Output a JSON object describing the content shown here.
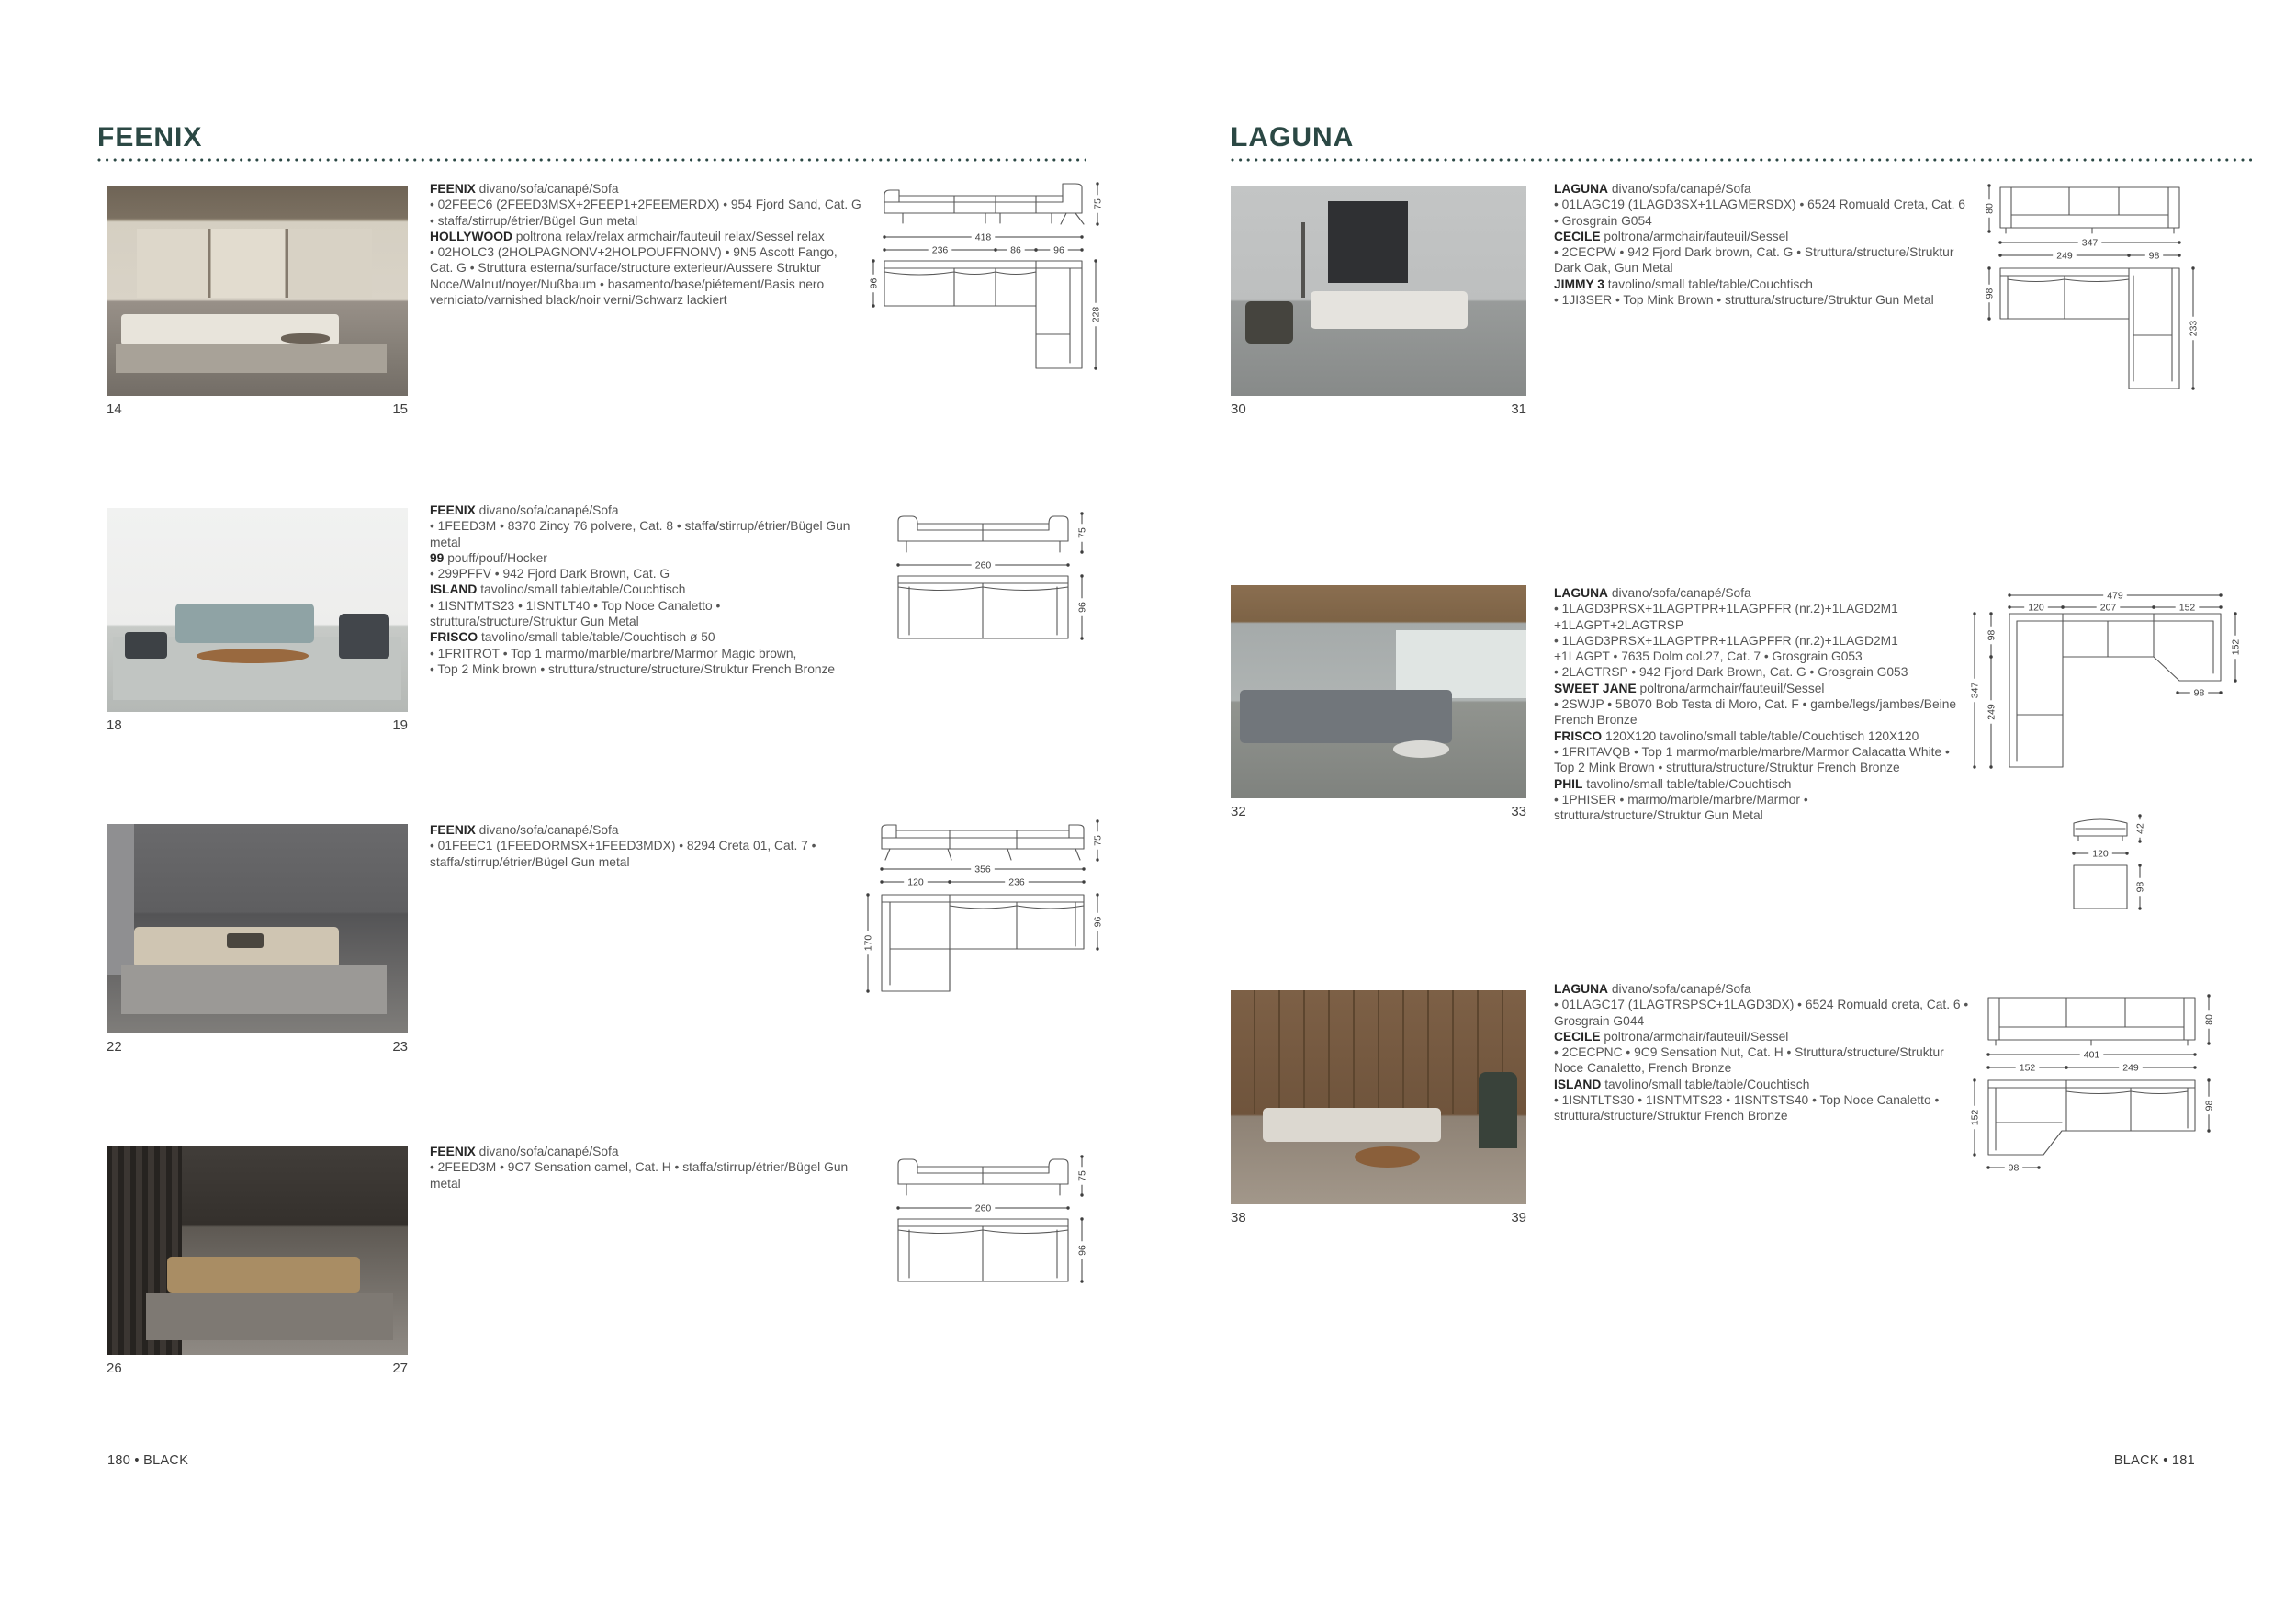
{
  "accent_color": "#2b4844",
  "pages": {
    "left": {
      "title": "FEENIX",
      "footer": "180 • BLACK",
      "blocks": [
        {
          "nums": {
            "l": "14",
            "r": "15"
          },
          "desc": [
            {
              "b": true,
              "t": "FEENIX"
            },
            {
              "t": " divano/sofa/canapé/Sofa\n"
            },
            {
              "t": "• 02FEEC6 (2FEED3MSX+2FEEP1+2FEEMERDX) • 954 Fjord Sand, Cat. G • staffa/stirrup/étrier/Bügel Gun metal\n"
            },
            {
              "b": true,
              "t": "HOLLYWOOD"
            },
            {
              "t": " poltrona relax/relax armchair/fauteuil relax/Sessel relax\n"
            },
            {
              "t": "• 02HOLC3 (2HOLPAGNONV+2HOLPOUFFNONV) • 9N5 Ascott Fango, Cat. G • Struttura esterna/surface/structure exterieur/Aussere Struktur Noce/Walnut/noyer/Nußbaum • basamento/base/piétement/Basis nero verniciato/varnished black/noir verni/Schwarz lackiert"
            }
          ]
        },
        {
          "nums": {
            "l": "18",
            "r": "19"
          },
          "desc": [
            {
              "b": true,
              "t": "FEENIX"
            },
            {
              "t": " divano/sofa/canapé/Sofa\n"
            },
            {
              "t": "• 1FEED3M • 8370 Zincy 76 polvere, Cat. 8 • staffa/stirrup/étrier/Bügel Gun metal\n"
            },
            {
              "b": true,
              "t": "99"
            },
            {
              "t": " pouff/pouf/Hocker\n"
            },
            {
              "t": "• 299PFFV • 942 Fjord Dark Brown, Cat. G\n"
            },
            {
              "b": true,
              "t": "ISLAND"
            },
            {
              "t": " tavolino/small table/table/Couchtisch\n"
            },
            {
              "t": "• 1ISNTMTS23 • 1ISNTLT40 • Top Noce Canaletto • struttura/structure/Struktur Gun Metal\n"
            },
            {
              "b": true,
              "t": "FRISCO"
            },
            {
              "t": " tavolino/small table/table/Couchtisch ø 50\n"
            },
            {
              "t": "• 1FRITROT • Top 1 marmo/marble/marbre/Marmor Magic brown,\n• Top 2 Mink brown • struttura/structure/structure/Struktur French Bronze"
            }
          ]
        },
        {
          "nums": {
            "l": "22",
            "r": "23"
          },
          "desc": [
            {
              "b": true,
              "t": "FEENIX"
            },
            {
              "t": " divano/sofa/canapé/Sofa\n"
            },
            {
              "t": "• 01FEEC1 (1FEEDORMSX+1FEED3MDX) • 8294 Creta 01, Cat. 7 • staffa/stirrup/étrier/Bügel Gun metal"
            }
          ]
        },
        {
          "nums": {
            "l": "26",
            "r": "27"
          },
          "desc": [
            {
              "b": true,
              "t": "FEENIX"
            },
            {
              "t": " divano/sofa/canapé/Sofa\n"
            },
            {
              "t": "• 2FEED3M • 9C7 Sensation camel, Cat. H • staffa/stirrup/étrier/Bügel Gun metal"
            }
          ]
        }
      ],
      "drawings": {
        "d1": {
          "height": "75",
          "total": "418",
          "seg1": "236",
          "seg2": "86",
          "seg3": "96",
          "depth": "96",
          "chaise": "228"
        },
        "d2": {
          "height": "75",
          "width": "260",
          "depth": "96"
        },
        "d3": {
          "height": "75",
          "total": "356",
          "seg1": "120",
          "seg2": "236",
          "chaise": "170",
          "depth": "96"
        },
        "d4": {
          "height": "75",
          "width": "260",
          "depth": "96"
        }
      }
    },
    "right": {
      "title": "LAGUNA",
      "footer": "BLACK • 181",
      "blocks": [
        {
          "nums": {
            "l": "30",
            "r": "31"
          },
          "desc": [
            {
              "b": true,
              "t": "LAGUNA"
            },
            {
              "t": " divano/sofa/canapé/Sofa\n"
            },
            {
              "t": "• 01LAGC19 (1LAGD3SX+1LAGMERSDX) • 6524 Romuald Creta, Cat. 6 • Grosgrain G054\n"
            },
            {
              "b": true,
              "t": "CECILE"
            },
            {
              "t": " poltrona/armchair/fauteuil/Sessel\n"
            },
            {
              "t": "• 2CECPW • 942 Fjord Dark brown, Cat. G • Struttura/structure/Struktur Dark Oak, Gun Metal\n"
            },
            {
              "b": true,
              "t": "JIMMY 3"
            },
            {
              "t": " tavolino/small table/table/Couchtisch\n"
            },
            {
              "t": "• 1JI3SER • Top Mink Brown • struttura/structure/Struktur Gun Metal"
            }
          ]
        },
        {
          "nums": {
            "l": "32",
            "r": "33"
          },
          "desc": [
            {
              "b": true,
              "t": "LAGUNA"
            },
            {
              "t": " divano/sofa/canapé/Sofa\n"
            },
            {
              "t": "• 1LAGD3PRSX+1LAGPTPR+1LAGPFFR (nr.2)+1LAGD2M1\n+1LAGPT+2LAGTRSP\n"
            },
            {
              "t": "• 1LAGD3PRSX+1LAGPTPR+1LAGPFFR (nr.2)+1LAGD2M1\n+1LAGPT • 7635 Dolm col.27, Cat. 7 • Grosgrain G053\n"
            },
            {
              "t": "• 2LAGTRSP • 942 Fjord Dark Brown, Cat. G • Grosgrain G053\n"
            },
            {
              "b": true,
              "t": "SWEET JANE"
            },
            {
              "t": " poltrona/armchair/fauteuil/Sessel\n"
            },
            {
              "t": "• 2SWJP • 5B070 Bob Testa di Moro, Cat. F • gambe/legs/jambes/Beine French Bronze\n"
            },
            {
              "b": true,
              "t": "FRISCO"
            },
            {
              "t": " 120X120 tavolino/small table/table/Couchtisch 120X120\n"
            },
            {
              "t": "• 1FRITAVQB • Top 1 marmo/marble/marbre/Marmor Calacatta White • Top 2 Mink Brown • struttura/structure/Struktur French Bronze\n"
            },
            {
              "b": true,
              "t": "PHIL"
            },
            {
              "t": " tavolino/small table/table/Couchtisch\n"
            },
            {
              "t": "• 1PHISER • marmo/marble/marbre/Marmor • struttura/structure/Struktur Gun Metal"
            }
          ]
        },
        {
          "nums": {
            "l": "38",
            "r": "39"
          },
          "desc": [
            {
              "b": true,
              "t": "LAGUNA"
            },
            {
              "t": " divano/sofa/canapé/Sofa\n"
            },
            {
              "t": "• 01LAGC17 (1LAGTRSPSC+1LAGD3DX) • 6524 Romuald creta, Cat. 6 • Grosgrain G044\n"
            },
            {
              "b": true,
              "t": "CECILE"
            },
            {
              "t": " poltrona/armchair/fauteuil/Sessel\n"
            },
            {
              "t": "• 2CECPNC • 9C9 Sensation Nut, Cat. H • Struttura/structure/Struktur Noce Canaletto, French Bronze\n"
            },
            {
              "b": true,
              "t": "ISLAND"
            },
            {
              "t": " tavolino/small table/table/Couchtisch\n"
            },
            {
              "t": "• 1ISNTLTS30 • 1ISNTMTS23 • 1ISNTSTS40 • Top Noce Canaletto • struttura/structure/Struktur French Bronze"
            }
          ]
        }
      ],
      "drawings": {
        "d5": {
          "height": "80",
          "total": "347",
          "seg1": "249",
          "seg2": "98",
          "depth": "98",
          "chaise": "233"
        },
        "d6": {
          "top_total": "479",
          "top1": "120",
          "top2": "207",
          "top3": "152",
          "left_total": "347",
          "left1": "98",
          "left2": "249",
          "right": "152",
          "inner": "98",
          "pouf_h": "42",
          "pouf_w": "120",
          "pouf_d": "98"
        },
        "d7": {
          "height": "80",
          "total": "401",
          "seg1": "152",
          "seg2": "249",
          "left": "152",
          "depth": "98",
          "bottom": "98"
        }
      }
    }
  }
}
